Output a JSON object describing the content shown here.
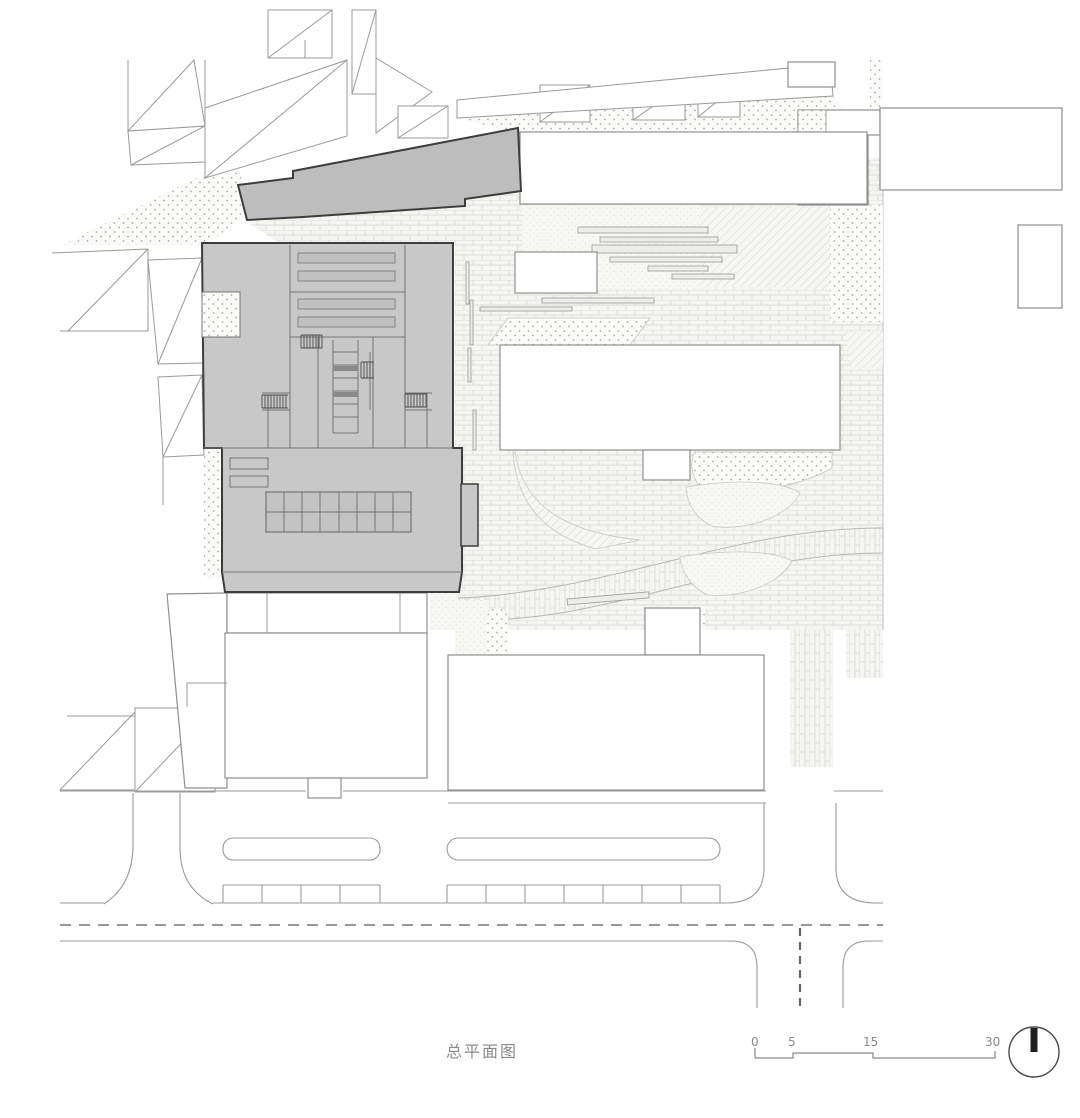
{
  "caption": {
    "text": "总平面图"
  },
  "scale_bar": {
    "labels": [
      "0",
      "5",
      "15",
      "30"
    ]
  },
  "north": {
    "icon": "north-indicator-circle-with-bar"
  },
  "colors": {
    "highlight_building": "#c8c8c8",
    "annex_building": "#bdbdbd",
    "outline_dark": "#3d3d3d",
    "context_line": "#9a9a9a",
    "north_marker": "#1f1f1f",
    "label_gray": "#8a8a8a"
  }
}
